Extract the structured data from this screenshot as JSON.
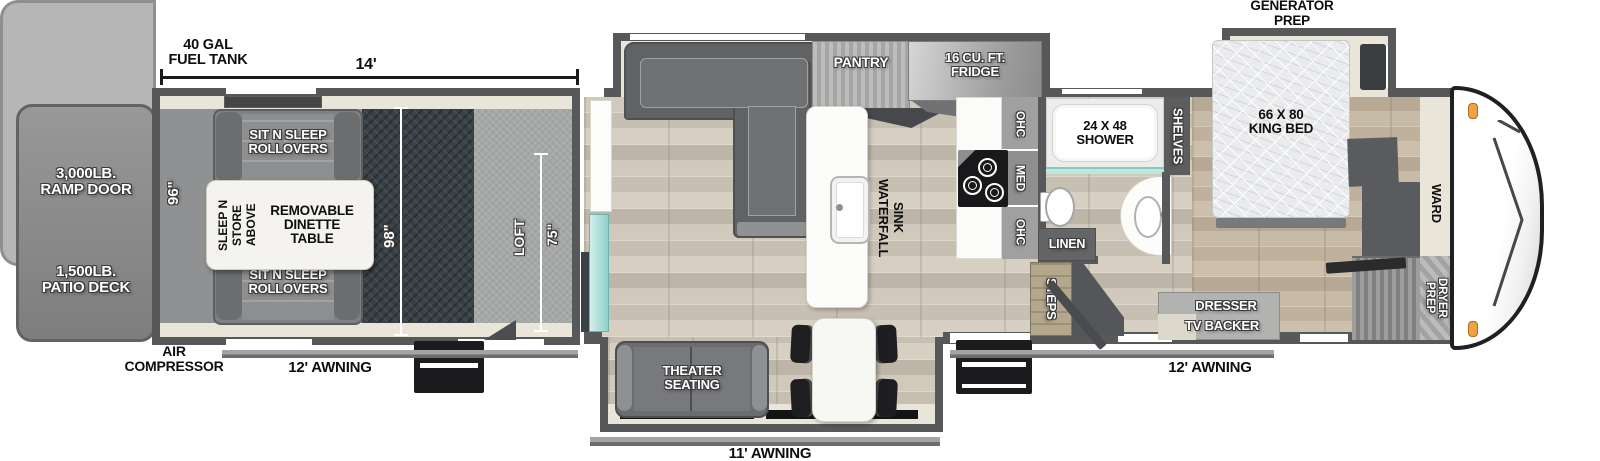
{
  "meta": {
    "type": "rv-toy-hauler-floorplan"
  },
  "colors": {
    "wall": "#56585a",
    "garage_carpet": "#394146",
    "glass_teal": "#8fd2cb",
    "clearance_light": "#eda33f",
    "wood_floor": "#cfc8bb",
    "bedroom_floor": "#c6baa7"
  },
  "rear": {
    "ramp_door_line1": "3,000LB.",
    "ramp_door_line2": "RAMP DOOR",
    "patio_deck_line1": "1,500LB.",
    "patio_deck_line2": "PATIO DECK"
  },
  "top": {
    "fuel_tank_line1": "40 GAL",
    "fuel_tank_line2": "FUEL TANK",
    "garage_length_dim": "14'",
    "generator_prep_line1": "GENERATOR",
    "generator_prep_line2": "PREP"
  },
  "garage": {
    "rollover_top_line1": "SIT N SLEEP",
    "rollover_top_line2": "ROLLOVERS",
    "rollover_bottom_line1": "SIT N SLEEP",
    "rollover_bottom_line2": "ROLLOVERS",
    "dinette_line1": "REMOVABLE",
    "dinette_line2": "DINETTE",
    "dinette_line3": "TABLE",
    "sleep_store_line1": "SLEEP N STORE",
    "sleep_store_line2": "ABOVE",
    "width_dim": "96\"",
    "length_dim": "98\"",
    "loft_label": "LOFT",
    "loft_dim": "75\""
  },
  "kitchen": {
    "pantry": "PANTRY",
    "fridge_line1": "16 CU. FT.",
    "fridge_line2": "FRIDGE",
    "sink_line1": "WATERFALL",
    "sink_line2": "SINK",
    "ohc_top": "OHC",
    "med": "MED",
    "ohc_bottom": "OHC"
  },
  "living": {
    "theater_line1": "THEATER",
    "theater_line2": "SEATING"
  },
  "bathroom": {
    "shower_line1": "24 X 48",
    "shower_line2": "SHOWER",
    "linen": "LINEN",
    "shelves": "SHELVES",
    "steps": "STEPS"
  },
  "bedroom": {
    "bed_line1": "66 X 80",
    "bed_line2": "KING BED",
    "ward": "WARD",
    "dresser_line1": "DRESSER",
    "dresser_line2": "TV BACKER",
    "washer_dryer_line1": "WASHER/",
    "washer_dryer_line2": "DRYER",
    "washer_dryer_line3": "PREP"
  },
  "annotations": {
    "awning_left": "12' AWNING",
    "awning_bottom": "11' AWNING",
    "awning_right": "12' AWNING",
    "air_compressor_line1": "AIR",
    "air_compressor_line2": "COMPRESSOR"
  }
}
